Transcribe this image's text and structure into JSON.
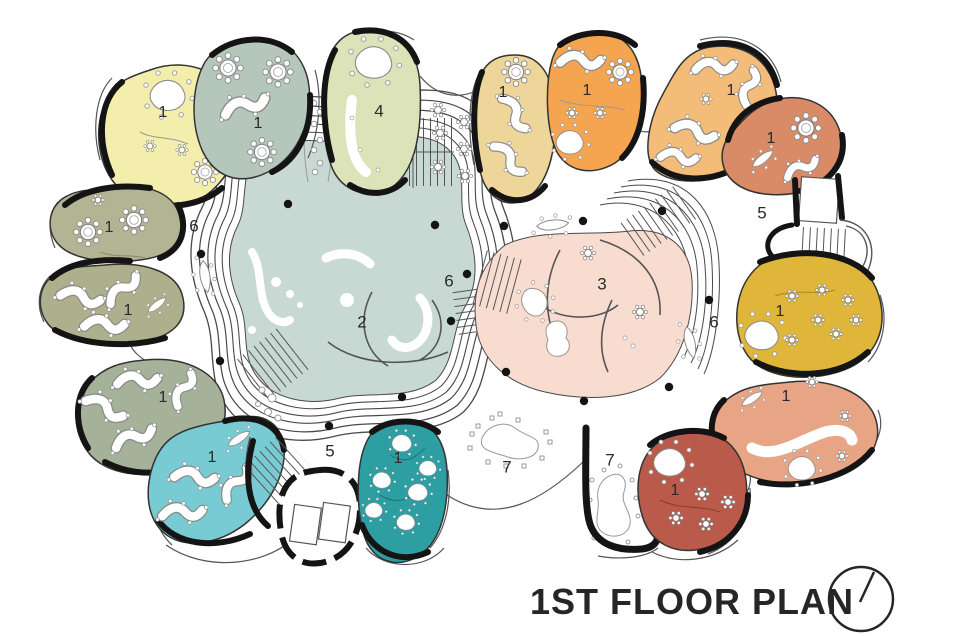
{
  "title": "1ST FLOOR PLAN",
  "compass": {
    "icon": "north-indicator"
  },
  "palette": {
    "ink": "#141414",
    "thin_line": "#3c3c3c",
    "furniture_stroke": "#8a8a8a",
    "background": "#ffffff"
  },
  "rooms": [
    {
      "name": "classroom-top-yellow",
      "label": "1",
      "color": "#f3eeab"
    },
    {
      "name": "classroom-top-sage",
      "label": "1",
      "color": "#b5c7ba"
    },
    {
      "name": "multipurpose-room-green",
      "label": "4",
      "color": "#dde3b8"
    },
    {
      "name": "classroom-top-wheat",
      "label": "1",
      "color": "#eed59a"
    },
    {
      "name": "classroom-top-orange",
      "label": "1",
      "color": "#f5a44f"
    },
    {
      "name": "classroom-topright-tan",
      "label": "1",
      "color": "#f3bd79"
    },
    {
      "name": "classroom-topright-salmon",
      "label": "1",
      "color": "#d98a66"
    },
    {
      "name": "classroom-right-mustard",
      "label": "1",
      "color": "#dfb639"
    },
    {
      "name": "classroom-right-pink",
      "label": "1",
      "color": "#e8a585"
    },
    {
      "name": "classroom-right-brick",
      "label": "1",
      "color": "#ba5a4a"
    },
    {
      "name": "classroom-left-olive-a",
      "label": "1",
      "color": "#b3b493"
    },
    {
      "name": "classroom-left-olive-b",
      "label": "1",
      "color": "#aeb08d"
    },
    {
      "name": "classroom-left-sage",
      "label": "1",
      "color": "#a6b199"
    },
    {
      "name": "classroom-bottom-lightteal",
      "label": "1",
      "color": "#79cbd3"
    },
    {
      "name": "classroom-bottom-darkteal",
      "label": "1",
      "color": "#2d9fa3"
    }
  ],
  "zones": [
    {
      "name": "central-hall",
      "label": "2",
      "color": "#c8d9d4"
    },
    {
      "name": "activity-area",
      "label": "3",
      "color": "#f8dcd0"
    },
    {
      "name": "stair-top-right",
      "label": "5"
    },
    {
      "name": "stair-bottom-left",
      "label": "5"
    },
    {
      "name": "corridor-left",
      "label": "6"
    },
    {
      "name": "corridor-center",
      "label": "6"
    },
    {
      "name": "corridor-right",
      "label": "6"
    },
    {
      "name": "play-area-left",
      "label": "7"
    },
    {
      "name": "play-area-right",
      "label": "7"
    }
  ]
}
